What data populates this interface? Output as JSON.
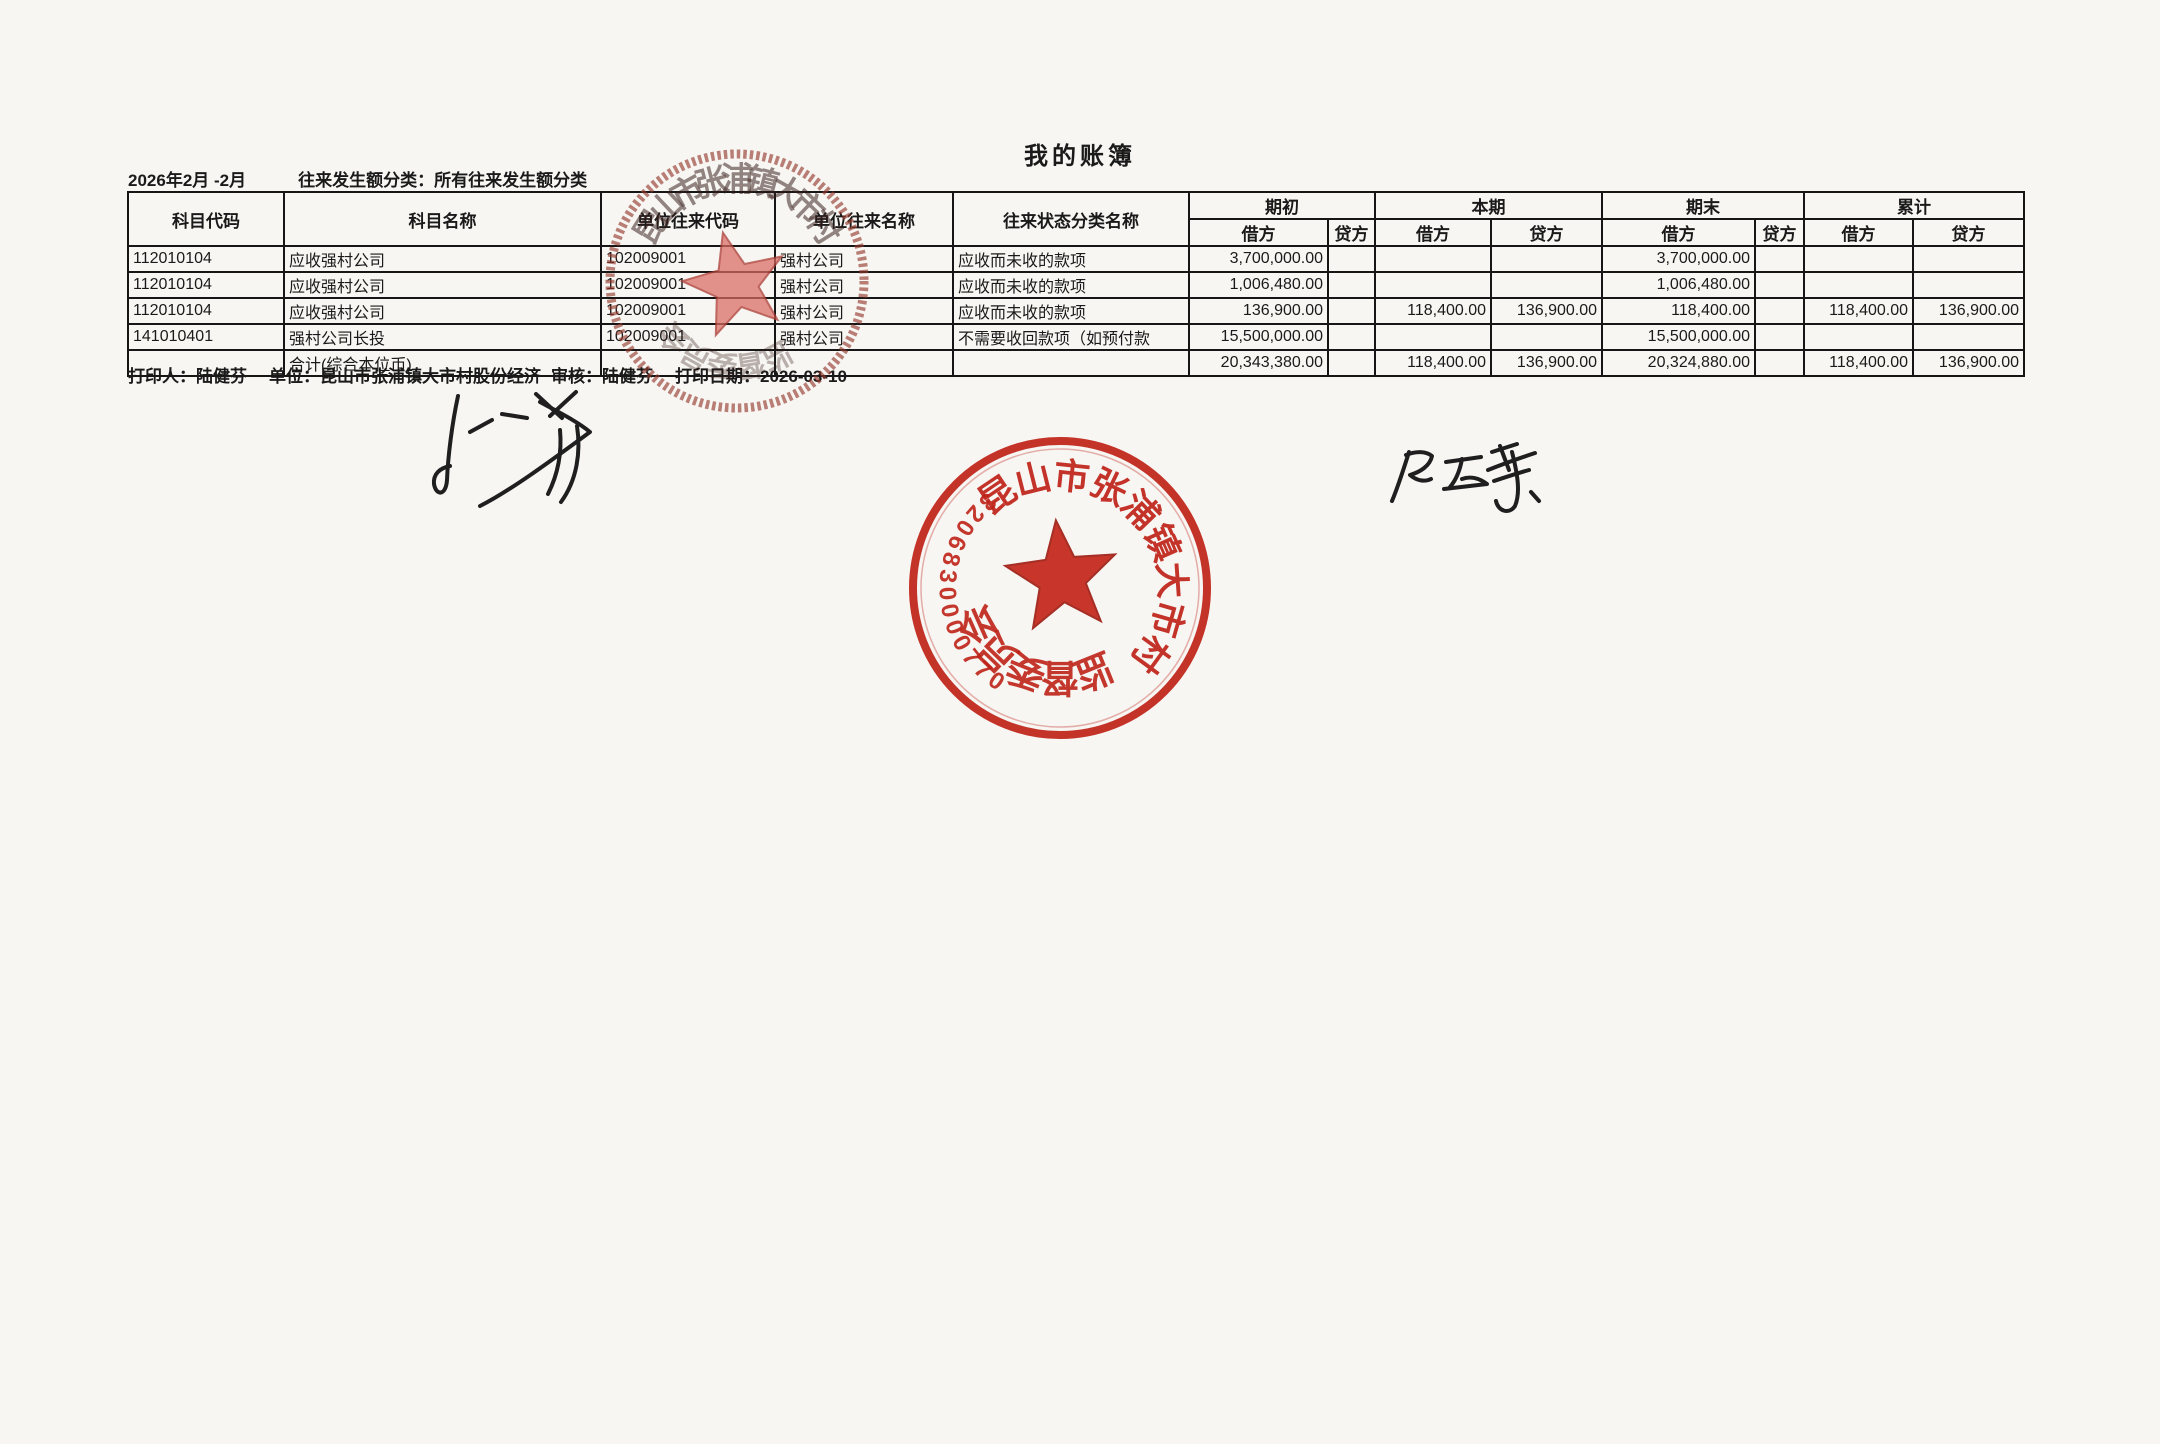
{
  "page": {
    "title": "我的账簿"
  },
  "meta": {
    "period": "2026年2月 -2月",
    "filter": "往来发生额分类：所有往来发生额分类"
  },
  "table": {
    "headers": {
      "code": "科目代码",
      "name": "科目名称",
      "partner_code": "单位往来代码",
      "partner_name": "单位往来名称",
      "status": "往来状态分类名称",
      "group_labels": [
        "期初",
        "本期",
        "期末",
        "累计"
      ],
      "debit": "借方",
      "credit": "贷方"
    },
    "rows": [
      {
        "code": "112010104",
        "name": "应收强村公司",
        "pcode": "102009001",
        "pname": "强村公司",
        "status": "应收而未收的款项",
        "ib": "3,700,000.00",
        "ic": "",
        "cb": "",
        "cc": "",
        "eb": "3,700,000.00",
        "ec": "",
        "ab": "",
        "ac": ""
      },
      {
        "code": "112010104",
        "name": "应收强村公司",
        "pcode": "102009001",
        "pname": "强村公司",
        "status": "应收而未收的款项",
        "ib": "1,006,480.00",
        "ic": "",
        "cb": "",
        "cc": "",
        "eb": "1,006,480.00",
        "ec": "",
        "ab": "",
        "ac": ""
      },
      {
        "code": "112010104",
        "name": "应收强村公司",
        "pcode": "102009001",
        "pname": "强村公司",
        "status": "应收而未收的款项",
        "ib": "136,900.00",
        "ic": "",
        "cb": "118,400.00",
        "cc": "136,900.00",
        "eb": "118,400.00",
        "ec": "",
        "ab": "118,400.00",
        "ac": "136,900.00"
      },
      {
        "code": "141010401",
        "name": "强村公司长投",
        "pcode": "102009001",
        "pname": "强村公司",
        "status": "不需要收回款项（如预付款",
        "ib": "15,500,000.00",
        "ic": "",
        "cb": "",
        "cc": "",
        "eb": "15,500,000.00",
        "ec": "",
        "ab": "",
        "ac": ""
      },
      {
        "code": "",
        "name": "合计(综合本位币)",
        "pcode": "",
        "pname": "",
        "status": "",
        "ib": "20,343,380.00",
        "ic": "",
        "cb": "118,400.00",
        "cc": "136,900.00",
        "eb": "20,324,880.00",
        "ec": "",
        "ab": "118,400.00",
        "ac": "136,900.00"
      }
    ]
  },
  "footer": {
    "printer": "打印人：陆健芬",
    "unit": "单位：昆山市张浦镇大市村股份经济",
    "auditor": "审核：陆健芬",
    "print_date": "打印日期：2026-03-10"
  },
  "seals": {
    "top": {
      "ring_text": "昆山市张浦镇大市村",
      "bottom_text": "监督委员会"
    },
    "main": {
      "ring_text": "昆山市张浦镇大市村",
      "bottom_text": "监督委员会",
      "number": "3206830000770"
    }
  },
  "colors": {
    "seal_red": "#bf2318",
    "seal_faded": "#8a3a2e",
    "ink": "#1f1f1f",
    "paper": "#f7f6f3"
  }
}
